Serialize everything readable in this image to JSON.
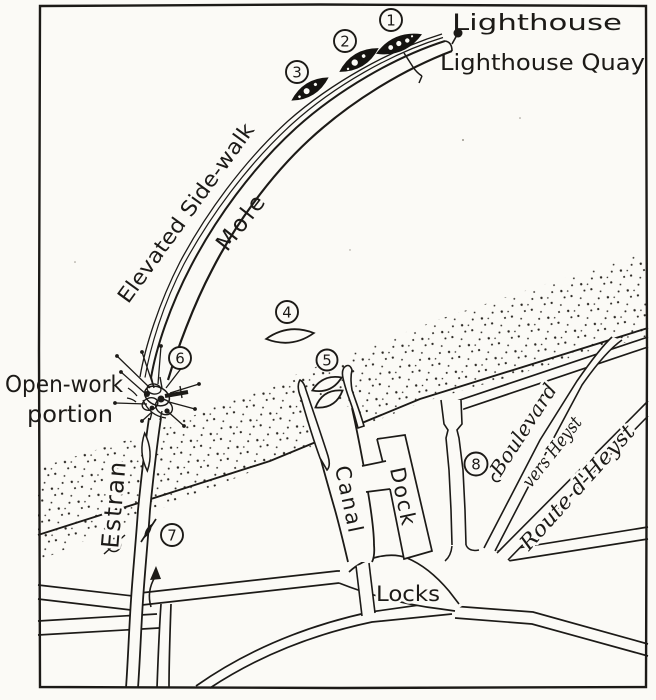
{
  "figure": {
    "description": "Hand-drawn map of the Zeebrugge Mole, canal and locks with numbered positions",
    "colors": {
      "ink": "#1c1a17",
      "paper": "#fbfaf6"
    },
    "labels": {
      "lighthouse": "Lighthouse",
      "lighthouse_quay": "Lighthouse Quay",
      "elevated_sidewalk": "Elevated Side-walk",
      "mole": "Mole",
      "open_work_line1": "Open-work",
      "open_work_line2": "portion",
      "estran": "Estran",
      "canal": "Canal",
      "dock": "Dock",
      "locks": "Locks",
      "boulevard_line1": "Boulevard",
      "boulevard_line2": "vers Heyst",
      "route_dheyst": "Route d'Heyst"
    },
    "markers": {
      "m1": "1",
      "m2": "2",
      "m3": "3",
      "m4": "4",
      "m5": "5",
      "m6": "6",
      "m7": "7",
      "m8": "8"
    }
  }
}
